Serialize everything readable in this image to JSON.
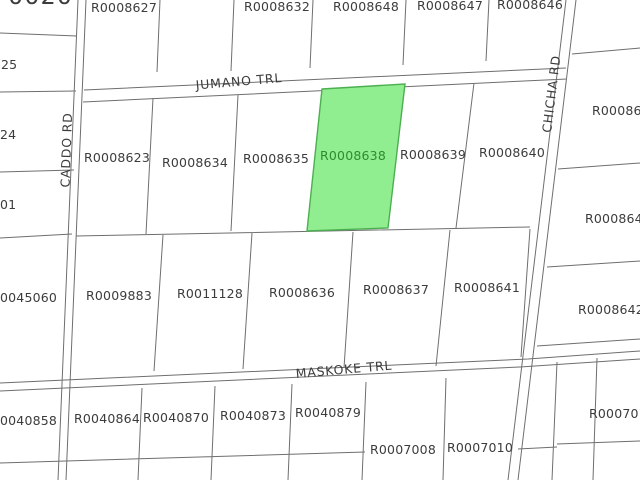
{
  "map": {
    "type": "parcel-map",
    "background_color": "#ffffff",
    "line_color": "#6e6e6e",
    "label_color": "#3c3c3c",
    "roads": {
      "jumano": "JUMANO TRL",
      "maskoke": "MASKOKE TRL",
      "caddo": "CADDO RD",
      "chicha": "CHICHA RD"
    },
    "highlight": {
      "parcel_id": "R0008638",
      "fill": "#90ee90",
      "stroke": "#4caf50",
      "label_color": "#2e8b2e"
    },
    "parcels": {
      "top_row": [
        "R0008627",
        "R0008632",
        "R0008648",
        "R0008647",
        "R0008646"
      ],
      "middle_row": [
        "R0008623",
        "R0008634",
        "R0008635",
        "R0008639",
        "R0008640"
      ],
      "third_row": [
        "R0009883",
        "R0011128",
        "R0008636",
        "R0008637",
        "R0008641"
      ],
      "bottom_row": [
        "R0040864",
        "R0040870",
        "R0040873",
        "R0040879",
        "R0007008",
        "R0007010"
      ],
      "east_edge_partial": [
        "R000864",
        "R000864",
        "R0008642",
        "R00070"
      ],
      "west_edge_partial": [
        "0020",
        "25",
        "24",
        "01",
        "0045060",
        "0040858"
      ]
    }
  }
}
